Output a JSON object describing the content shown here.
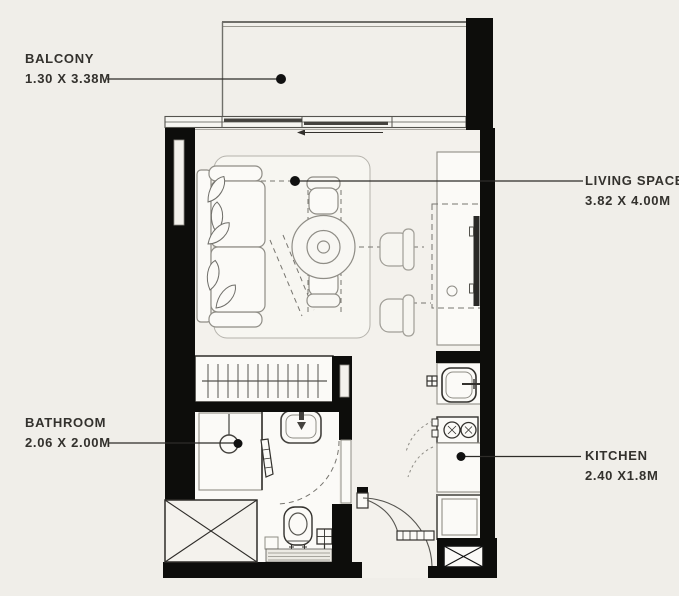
{
  "plan": {
    "type": "studio-apartment-floor-plan",
    "background": "#f0eee9",
    "wall_color": "#0d0d0b",
    "line_color": "#8f8d86",
    "text_color": "#33312d"
  },
  "labels": {
    "balcony": {
      "name": "BALCONY",
      "dims": "1.30 X 3.38M"
    },
    "living": {
      "name": "LIVING SPACE",
      "dims": "3.82 X 4.00M"
    },
    "bathroom": {
      "name": "BATHROOM",
      "dims": "2.06 X 2.00M"
    },
    "kitchen": {
      "name": "KITCHEN",
      "dims": "2.40 X1.8M"
    }
  }
}
